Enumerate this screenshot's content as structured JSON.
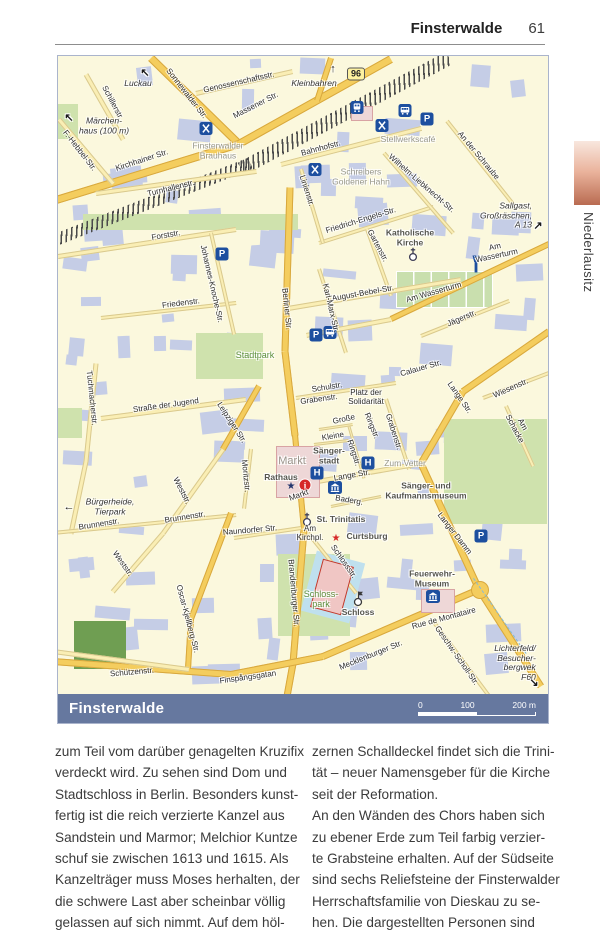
{
  "page": {
    "header_title": "Finsterwalde",
    "page_number": "61",
    "sidebar_tab": "Niederlausitz"
  },
  "map": {
    "footer_label": "Finsterwalde",
    "route_badge": "96",
    "scale_ticks": [
      "0",
      "100",
      "200 m"
    ],
    "colors": {
      "icon_blue": "#1d4f9f",
      "info_red": "#d62828",
      "road_major": "#f4cd5e",
      "road_minor": "#faeeb4",
      "park": "#cfe2ad",
      "building": "#c5cde6",
      "footer_bar": "#66789f"
    },
    "labels": [
      {
        "t": "Sonnewalder Str.",
        "x": 128,
        "y": 38,
        "r": 52
      },
      {
        "t": "Genossenschaftsstr.",
        "x": 181,
        "y": 27,
        "r": -13
      },
      {
        "t": "Massener Str.",
        "x": 198,
        "y": 50,
        "r": -27
      },
      {
        "t": "Schillerstr.",
        "x": 54,
        "y": 47,
        "r": 62
      },
      {
        "t": "F.-Hebbel-Str.",
        "x": 21,
        "y": 95,
        "r": 52
      },
      {
        "t": "Kirchhainer Str.",
        "x": 84,
        "y": 105,
        "r": -18
      },
      {
        "t": "Turnhallenstr.",
        "x": 113,
        "y": 133,
        "r": -14
      },
      {
        "t": "Bahnhofstr.",
        "x": 263,
        "y": 93,
        "r": -15
      },
      {
        "t": "Wilhelm-Liebknecht-Str.",
        "x": 363,
        "y": 128,
        "r": 41
      },
      {
        "t": "An der Schraube",
        "x": 420,
        "y": 100,
        "r": 50
      },
      {
        "t": "Linienstr.",
        "x": 248,
        "y": 135,
        "r": 72
      },
      {
        "t": "Friedrich-Engels-Str.",
        "x": 303,
        "y": 165,
        "r": -17
      },
      {
        "t": "Gartenstr.",
        "x": 319,
        "y": 190,
        "r": 62
      },
      {
        "t": "Forststr.",
        "x": 108,
        "y": 180,
        "r": -10
      },
      {
        "t": "Johannes-Knoche-Str.",
        "x": 153,
        "y": 228,
        "r": 77
      },
      {
        "t": "Friedenstr.",
        "x": 123,
        "y": 248,
        "r": -7
      },
      {
        "t": "Berliner Str.",
        "x": 228,
        "y": 253,
        "r": 84
      },
      {
        "t": "Am  Wasserturm",
        "x": 438,
        "y": 196,
        "r": -12
      },
      {
        "t": "Am Wasserturm",
        "x": 376,
        "y": 237,
        "r": -16
      },
      {
        "t": "Jägerstr.",
        "x": 404,
        "y": 263,
        "r": -23
      },
      {
        "t": "August-Bebel-Str.",
        "x": 305,
        "y": 238,
        "r": -10
      },
      {
        "t": "Karl-Marx-Str.",
        "x": 272,
        "y": 252,
        "r": 77
      },
      {
        "t": "Calauer Str.",
        "x": 363,
        "y": 313,
        "r": -16
      },
      {
        "t": "Lange Str.",
        "x": 401,
        "y": 342,
        "r": 55
      },
      {
        "t": "Wiesenstr.",
        "x": 453,
        "y": 333,
        "r": -24
      },
      {
        "t": "Am Schacke",
        "x": 460,
        "y": 371,
        "r": 62
      },
      {
        "t": "Tuchmacherstr.",
        "x": 33,
        "y": 342,
        "r": 84
      },
      {
        "t": "Straße der Jugend",
        "x": 108,
        "y": 350,
        "r": -8
      },
      {
        "t": "Leipziger Str.",
        "x": 173,
        "y": 367,
        "r": 57
      },
      {
        "t": "Schulstr.",
        "x": 269,
        "y": 332,
        "r": -9
      },
      {
        "t": "Grabenstr.",
        "x": 261,
        "y": 344,
        "r": -8
      },
      {
        "t": "Platz der\nSolidarität",
        "x": 308,
        "y": 342,
        "r": 0
      },
      {
        "t": "Große",
        "x": 286,
        "y": 364,
        "r": -12
      },
      {
        "t": "Ringstr.",
        "x": 313,
        "y": 370,
        "r": 68
      },
      {
        "t": "Kleine",
        "x": 275,
        "y": 381,
        "r": -10
      },
      {
        "t": "Ringstr.",
        "x": 295,
        "y": 397,
        "r": 72
      },
      {
        "t": "Grabenstr.",
        "x": 335,
        "y": 376,
        "r": 72
      },
      {
        "t": "Lange Str.",
        "x": 294,
        "y": 420,
        "r": -10
      },
      {
        "t": "Markt",
        "x": 241,
        "y": 440,
        "r": -20
      },
      {
        "t": "Baderg.",
        "x": 291,
        "y": 445,
        "r": 10
      },
      {
        "t": "Moritzstr.",
        "x": 187,
        "y": 420,
        "r": 84
      },
      {
        "t": "Weststr.",
        "x": 123,
        "y": 435,
        "r": 63
      },
      {
        "t": "Brunnenstr.",
        "x": 41,
        "y": 469,
        "r": -9
      },
      {
        "t": "Brunnenstr.",
        "x": 127,
        "y": 462,
        "r": -9
      },
      {
        "t": "Naundorfer Str.",
        "x": 192,
        "y": 475,
        "r": -5
      },
      {
        "t": "Am\nKirchpl.",
        "x": 252,
        "y": 478,
        "r": 0
      },
      {
        "t": "Langer Damm",
        "x": 396,
        "y": 478,
        "r": 52
      },
      {
        "t": "Schlossstr.",
        "x": 285,
        "y": 506,
        "r": 55
      },
      {
        "t": "Weststr.",
        "x": 64,
        "y": 508,
        "r": 55
      },
      {
        "t": "Oscar-Kjellberg-Str.",
        "x": 129,
        "y": 563,
        "r": 75
      },
      {
        "t": "Brandenburger Str.",
        "x": 235,
        "y": 537,
        "r": 85
      },
      {
        "t": "Rue de Montataire",
        "x": 386,
        "y": 563,
        "r": -15
      },
      {
        "t": "Mecklenburger Str.",
        "x": 313,
        "y": 600,
        "r": -22
      },
      {
        "t": "Geschw.-Scholl-Str.",
        "x": 398,
        "y": 600,
        "r": 55
      },
      {
        "t": "Schützenstr.",
        "x": 74,
        "y": 617,
        "r": -5
      },
      {
        "t": "Finspångsgatan",
        "x": 190,
        "y": 622,
        "r": -8
      },
      {
        "t": "Finsterwalder\nBrauhaus",
        "x": 160,
        "y": 95,
        "c": "poi"
      },
      {
        "t": "Stellwerkscafé",
        "x": 350,
        "y": 84,
        "c": "poi"
      },
      {
        "t": "Schreibers\nGoldener Hahn",
        "x": 303,
        "y": 121,
        "c": "poi"
      },
      {
        "t": "Zum Vetter",
        "x": 347,
        "y": 408,
        "c": "poi"
      },
      {
        "t": "Katholische\nKirche",
        "x": 352,
        "y": 182,
        "c": "poid"
      },
      {
        "t": "Sänger-\nstadt",
        "x": 271,
        "y": 400,
        "c": "poid"
      },
      {
        "t": "Rathaus",
        "x": 223,
        "y": 422,
        "c": "poid"
      },
      {
        "t": "Markt",
        "x": 234,
        "y": 405,
        "c": "quarter"
      },
      {
        "t": "Sänger- und Kaufmannsmuseum",
        "x": 368,
        "y": 435,
        "c": "poid"
      },
      {
        "t": "St. Trinitatis",
        "x": 283,
        "y": 464,
        "c": "poid"
      },
      {
        "t": "Curtsburg",
        "x": 309,
        "y": 481,
        "c": "poid"
      },
      {
        "t": "Feuerwehr-\nMuseum",
        "x": 374,
        "y": 523,
        "c": "poid"
      },
      {
        "t": "Schloss",
        "x": 300,
        "y": 557,
        "c": "poid"
      },
      {
        "t": "Stadtpark",
        "x": 197,
        "y": 299,
        "c": "green"
      },
      {
        "t": "Schloss-\npark",
        "x": 263,
        "y": 543,
        "c": "green"
      },
      {
        "t": "Luckau",
        "x": 80,
        "y": 28,
        "c": "dest"
      },
      {
        "t": "Kleinbahren",
        "x": 256,
        "y": 28,
        "c": "dest"
      },
      {
        "t": "Märchen-\nhaus (100 m)",
        "x": 46,
        "y": 70,
        "c": "dest"
      },
      {
        "t": "Bürgerheide,\nTierpark",
        "x": 52,
        "y": 451,
        "c": "dest"
      },
      {
        "t": "Sallgast,\nGroßräschen,\nA 13",
        "x": 448,
        "y": 160,
        "c": "dest right"
      },
      {
        "t": "Lichterfeld/\nBesucher-\nbergwek F60",
        "x": 457,
        "y": 607,
        "c": "dest right"
      },
      {
        "t": "↑",
        "x": 275,
        "y": 13,
        "c": "arw"
      },
      {
        "t": "↖",
        "x": 87,
        "y": 17,
        "c": "arw"
      },
      {
        "t": "↖",
        "x": 11,
        "y": 62,
        "c": "arw"
      },
      {
        "t": "←",
        "x": 11,
        "y": 451,
        "c": "arw"
      },
      {
        "t": "↗",
        "x": 480,
        "y": 170,
        "c": "arw"
      },
      {
        "t": "↘",
        "x": 476,
        "y": 627,
        "c": "arw"
      }
    ],
    "icons": [
      {
        "k": "restaurant",
        "x": 148,
        "y": 75
      },
      {
        "k": "restaurant",
        "x": 324,
        "y": 72
      },
      {
        "k": "restaurant",
        "x": 257,
        "y": 116
      },
      {
        "k": "train",
        "x": 299,
        "y": 54
      },
      {
        "k": "bus",
        "x": 347,
        "y": 57
      },
      {
        "k": "bus",
        "x": 272,
        "y": 279
      },
      {
        "k": "parking",
        "x": 369,
        "y": 63
      },
      {
        "k": "parking",
        "x": 164,
        "y": 198
      },
      {
        "k": "parking",
        "x": 258,
        "y": 279
      },
      {
        "k": "parking",
        "x": 423,
        "y": 480
      },
      {
        "k": "hotel",
        "x": 259,
        "y": 417
      },
      {
        "k": "hotel",
        "x": 310,
        "y": 407
      },
      {
        "k": "museum",
        "x": 277,
        "y": 434
      },
      {
        "k": "museum",
        "x": 375,
        "y": 543
      },
      {
        "k": "church",
        "x": 355,
        "y": 201
      },
      {
        "k": "church",
        "x": 249,
        "y": 466
      },
      {
        "k": "tower",
        "x": 418,
        "y": 211
      },
      {
        "k": "castle",
        "x": 300,
        "y": 545
      },
      {
        "k": "info",
        "x": 247,
        "y": 429
      },
      {
        "k": "stard",
        "x": 233,
        "y": 429
      },
      {
        "k": "starr",
        "x": 278,
        "y": 481
      },
      {
        "k": "badge",
        "x": 298,
        "y": 18
      }
    ],
    "roads": [
      [
        93,
        2,
        181,
        88,
        8,
        "a"
      ],
      [
        181,
        88,
        333,
        3,
        8,
        "a"
      ],
      [
        181,
        88,
        -5,
        145,
        8,
        "a"
      ],
      [
        273,
        2,
        259,
        45,
        6,
        "a"
      ],
      [
        138,
        37,
        235,
        15,
        5,
        "b"
      ],
      [
        28,
        18,
        65,
        83,
        5,
        "b"
      ],
      [
        1,
        63,
        55,
        127,
        5,
        "b"
      ],
      [
        38,
        137,
        198,
        115,
        5,
        "b"
      ],
      [
        223,
        108,
        363,
        72,
        5,
        "b"
      ],
      [
        232,
        131,
        227,
        295,
        7,
        "a"
      ],
      [
        227,
        295,
        237,
        379,
        7,
        "a"
      ],
      [
        237,
        379,
        246,
        473,
        6,
        "a"
      ],
      [
        246,
        473,
        235,
        607,
        7,
        "a"
      ],
      [
        235,
        607,
        229,
        640,
        7,
        "a"
      ],
      [
        0,
        200,
        178,
        173,
        5,
        "b"
      ],
      [
        43,
        262,
        178,
        247,
        4,
        "b"
      ],
      [
        153,
        177,
        176,
        278,
        4,
        "b"
      ],
      [
        261,
        187,
        375,
        151,
        4,
        "b"
      ],
      [
        326,
        97,
        395,
        177,
        4,
        "b"
      ],
      [
        389,
        65,
        459,
        153,
        4,
        "b"
      ],
      [
        243,
        113,
        265,
        187,
        4,
        "b"
      ],
      [
        309,
        173,
        333,
        240,
        4,
        "b"
      ],
      [
        261,
        213,
        288,
        297,
        4,
        "b"
      ],
      [
        230,
        252,
        403,
        223,
        5,
        "b"
      ],
      [
        333,
        263,
        491,
        188,
        6,
        "a"
      ],
      [
        333,
        263,
        248,
        279,
        5,
        "b"
      ],
      [
        363,
        280,
        451,
        245,
        4,
        "b"
      ],
      [
        491,
        275,
        405,
        335,
        7,
        "a"
      ],
      [
        405,
        335,
        363,
        407,
        7,
        "a"
      ],
      [
        363,
        407,
        421,
        533,
        7,
        "a"
      ],
      [
        421,
        533,
        265,
        600,
        7,
        "a"
      ],
      [
        265,
        600,
        173,
        618,
        7,
        "a"
      ],
      [
        173,
        618,
        -5,
        605,
        7,
        "a"
      ],
      [
        421,
        533,
        483,
        630,
        7,
        "a"
      ],
      [
        425,
        342,
        491,
        317,
        4,
        "b"
      ],
      [
        448,
        350,
        475,
        410,
        4,
        "b"
      ],
      [
        238,
        342,
        338,
        327,
        4,
        "b"
      ],
      [
        328,
        343,
        351,
        413,
        4,
        "b"
      ],
      [
        43,
        362,
        188,
        343,
        5,
        "b"
      ],
      [
        201,
        330,
        165,
        393,
        6,
        "a"
      ],
      [
        165,
        393,
        105,
        477,
        5,
        "b"
      ],
      [
        105,
        477,
        55,
        535,
        5,
        "b"
      ],
      [
        38,
        307,
        28,
        405,
        5,
        "b"
      ],
      [
        28,
        405,
        13,
        477,
        5,
        "b"
      ],
      [
        -5,
        477,
        178,
        459,
        4,
        "b"
      ],
      [
        176,
        482,
        243,
        472,
        4,
        "b"
      ],
      [
        193,
        393,
        186,
        453,
        4,
        "b"
      ],
      [
        173,
        457,
        133,
        563,
        6,
        "a"
      ],
      [
        133,
        563,
        130,
        613,
        6,
        "a"
      ],
      [
        -5,
        595,
        131,
        613,
        5,
        "b"
      ],
      [
        250,
        477,
        298,
        537,
        4,
        "b"
      ],
      [
        375,
        565,
        431,
        640,
        4,
        "b"
      ],
      [
        291,
        370,
        306,
        422,
        3,
        "b"
      ],
      [
        261,
        373,
        295,
        368,
        3,
        "b"
      ],
      [
        256,
        388,
        291,
        384,
        3,
        "b"
      ],
      [
        248,
        427,
        363,
        407,
        5,
        "b"
      ],
      [
        273,
        450,
        323,
        440,
        3,
        "b"
      ]
    ],
    "circles": [
      [
        421,
        533,
        8
      ]
    ],
    "railways": [
      [
        0,
        183,
        193,
        107,
        12
      ],
      [
        183,
        113,
        391,
        2,
        14
      ]
    ],
    "parks": [
      [
        138,
        277,
        67,
        46,
        ""
      ],
      [
        220,
        498,
        72,
        82,
        ""
      ],
      [
        338,
        215,
        95,
        35,
        "court"
      ],
      [
        386,
        363,
        103,
        105,
        ""
      ],
      [
        0,
        48,
        20,
        35,
        ""
      ],
      [
        0,
        352,
        24,
        30,
        ""
      ],
      [
        16,
        565,
        52,
        48,
        "dark"
      ],
      [
        25,
        158,
        215,
        16,
        ""
      ]
    ],
    "waters": [
      [
        250,
        500,
        50,
        62,
        15
      ]
    ],
    "wdashes": [
      [
        395,
        560,
        92,
        55
      ]
    ],
    "landmarks": [
      [
        293,
        50,
        20,
        13,
        0,
        ""
      ],
      [
        218,
        390,
        42,
        50,
        0,
        ""
      ],
      [
        363,
        533,
        32,
        22,
        0,
        ""
      ],
      [
        258,
        506,
        30,
        48,
        15,
        "red"
      ]
    ]
  },
  "article": {
    "left_lines": [
      "zum Teil vom darüber genagelten Kruzifix",
      "verdeckt wird. Zu sehen sind Dom und",
      "Stadtschloss in Berlin. Besonders kunst-",
      "fertig ist die reich verzierte Kanzel aus",
      "Sandstein und Marmor; Melchior Kuntze",
      "schuf sie zwischen 1613 und 1615. Als",
      "Kanzelträger muss Moses herhalten, der",
      "die schwere Last aber scheinbar völlig",
      "gelassen auf sich nimmt. Auf dem höl-"
    ],
    "right_lines": [
      "zernen Schalldeckel findet sich die Trini-",
      "tät – neuer Namensgeber für die Kirche",
      "seit der Reformation.",
      "An den Wänden des Chors haben sich",
      "zu ebener Erde zum Teil farbig verzier-",
      "te Grabsteine erhalten. Auf der Südseite",
      "sind sechs Reliefsteine der Finsterwalder",
      "Herrschaftsfamilie von Dieskau zu se-",
      "hen. Die dargestellten Personen sind"
    ]
  }
}
